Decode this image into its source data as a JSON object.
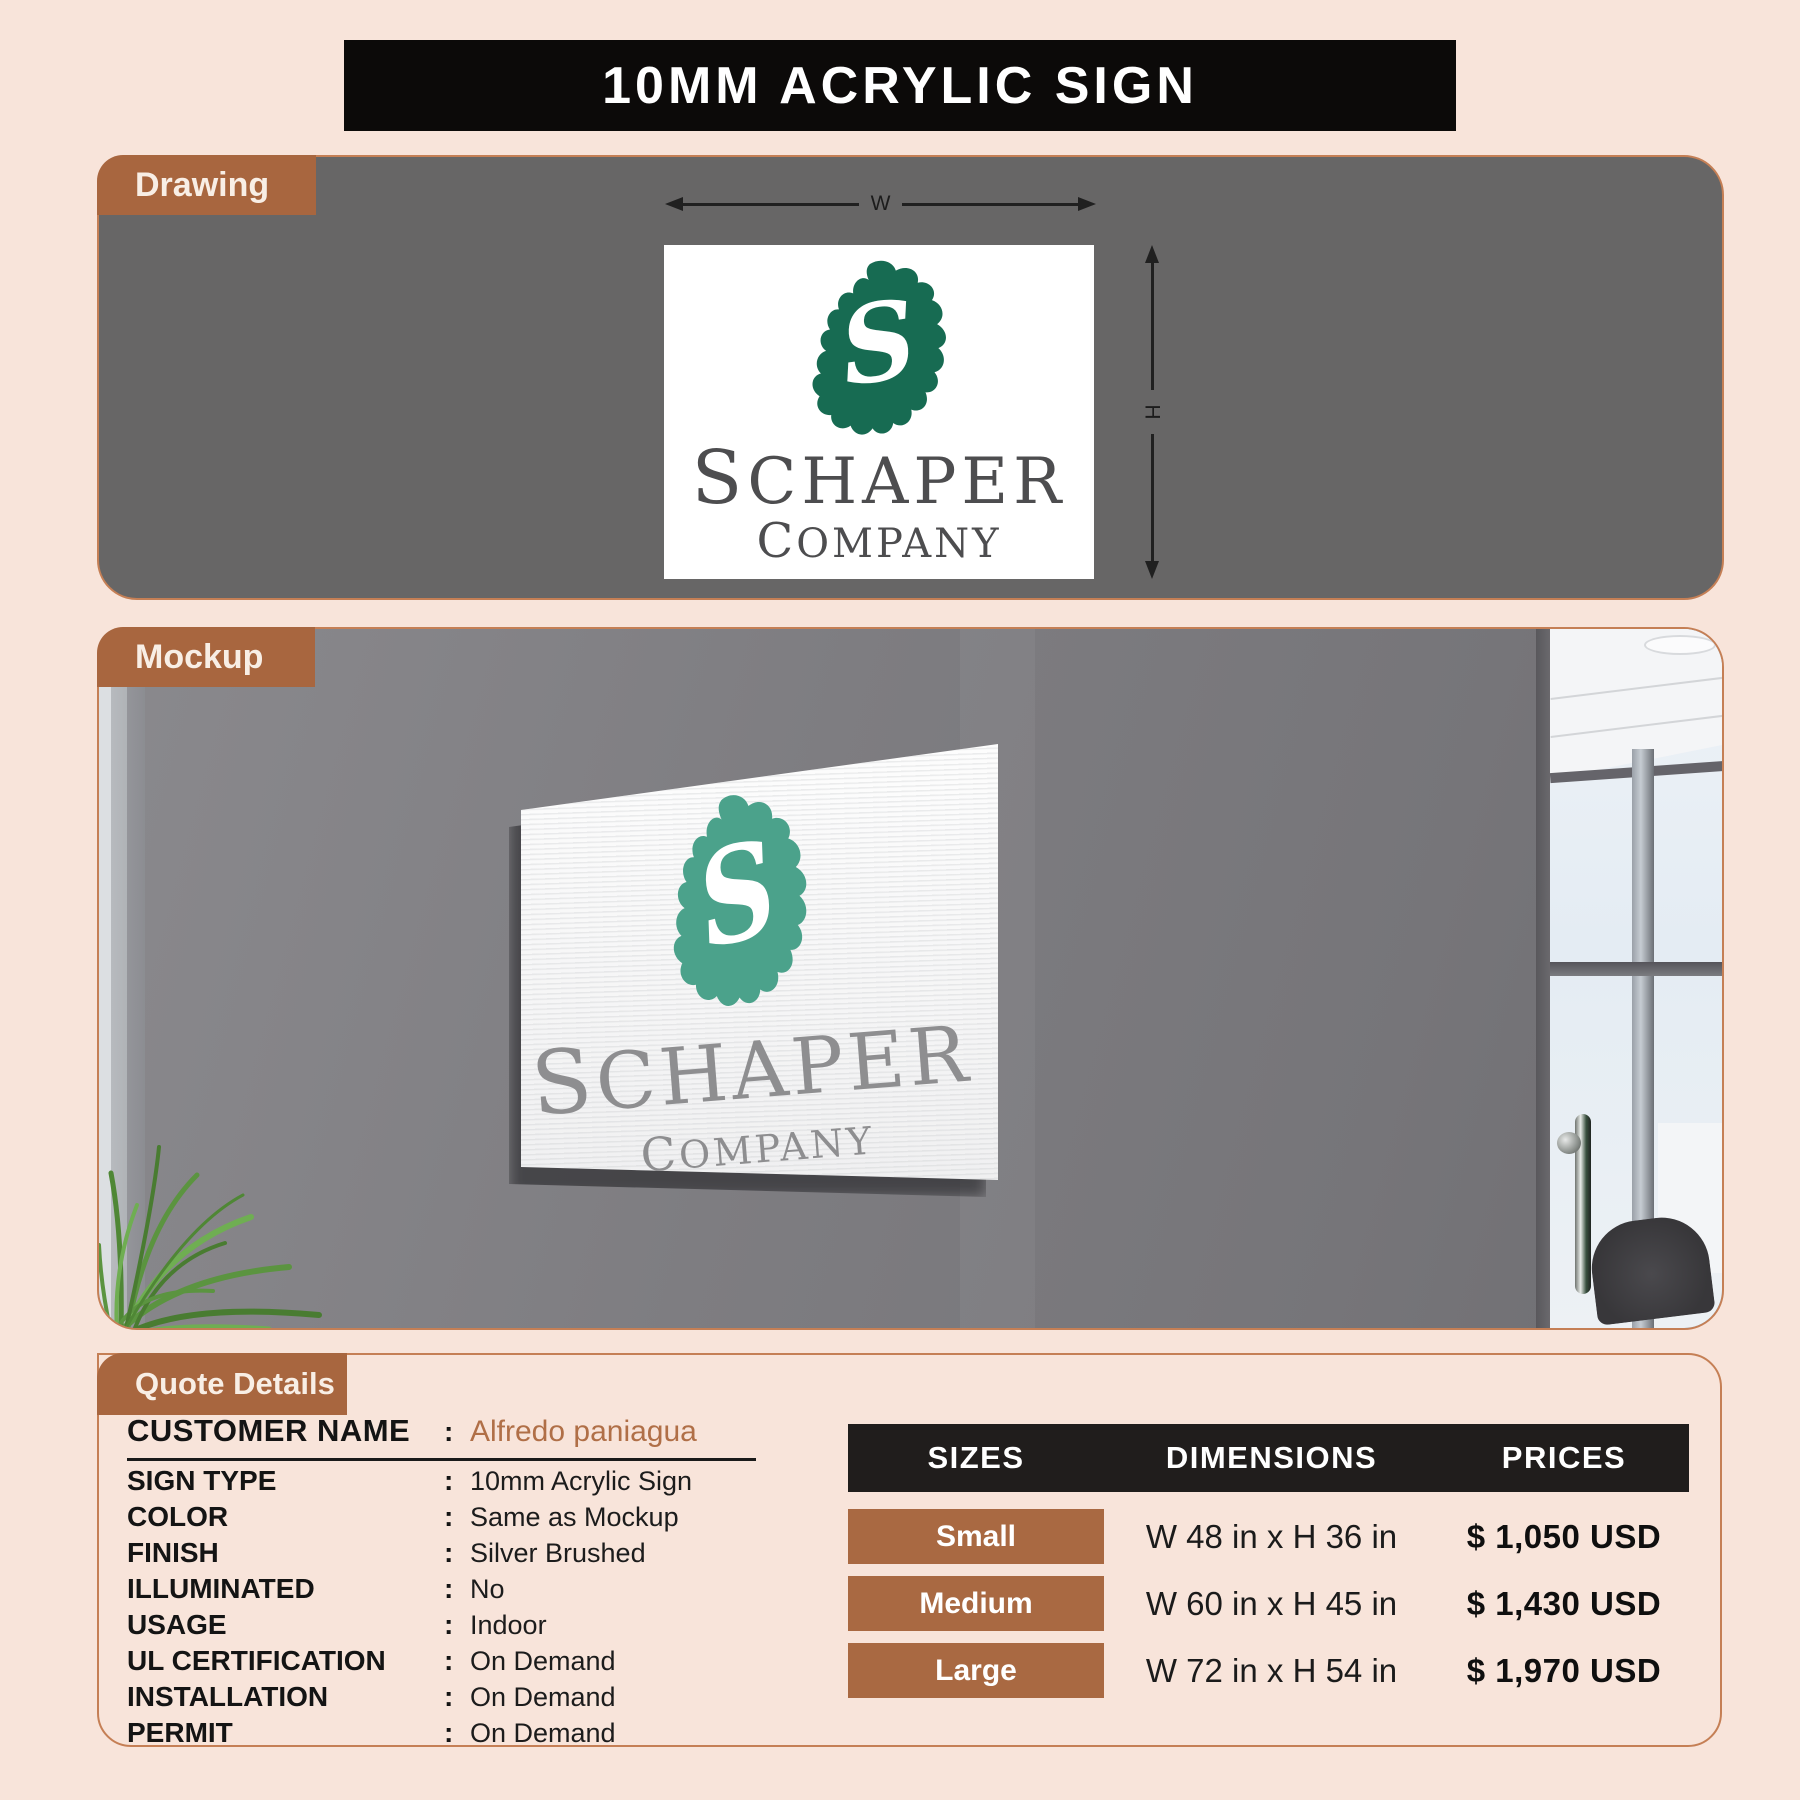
{
  "title": "10MM ACRYLIC SIGN",
  "colors": {
    "background": "#f8e4da",
    "banner_black": "#0c0a09",
    "tab_brown": "#a8663f",
    "panel_border_orange": "#c57f55",
    "drawing_panel_gray": "#676666",
    "mockup_wall_gray": "#7d7c80",
    "logo_green_drawing": "#176b52",
    "logo_teal_mockup": "#4ba28b",
    "customer_name_brown": "#b06f47",
    "table_header_black": "#201d1c",
    "size_button_brown": "#a96942"
  },
  "drawing_section": {
    "tab": "Drawing",
    "dim_w": "W",
    "dim_h": "H",
    "sign": {
      "monogram": "S",
      "name_initial": "S",
      "name_rest": "CHAPER",
      "subtitle_initial": "C",
      "subtitle_rest": "OMPANY"
    }
  },
  "mockup_section": {
    "tab": "Mockup",
    "sign": {
      "monogram": "S",
      "name_initial": "S",
      "name_rest": "CHAPER",
      "subtitle_initial": "C",
      "subtitle_rest": "OMPANY"
    }
  },
  "quote_section": {
    "tab": "Quote Details",
    "colon": ":",
    "customer": {
      "label": "CUSTOMER NAME",
      "value": "Alfredo paniagua"
    },
    "details": [
      {
        "label": "SIGN TYPE",
        "value": "10mm Acrylic Sign"
      },
      {
        "label": "COLOR",
        "value": "Same as Mockup"
      },
      {
        "label": "FINISH",
        "value": "Silver Brushed"
      },
      {
        "label": "ILLUMINATED",
        "value": "No"
      },
      {
        "label": "USAGE",
        "value": "Indoor"
      },
      {
        "label": "UL CERTIFICATION",
        "value": "On Demand"
      },
      {
        "label": "INSTALLATION",
        "value": "On Demand"
      },
      {
        "label": "PERMIT",
        "value": "On Demand"
      }
    ],
    "table": {
      "headers": [
        "SIZES",
        "DIMENSIONS",
        "PRICES"
      ],
      "rows": [
        {
          "size": "Small",
          "dimensions": "W 48 in x H 36 in",
          "price": "$ 1,050 USD"
        },
        {
          "size": "Medium",
          "dimensions": "W 60 in x H 45 in",
          "price": "$ 1,430 USD"
        },
        {
          "size": "Large",
          "dimensions": "W 72 in x H 54 in",
          "price": "$ 1,970 USD"
        }
      ]
    }
  }
}
